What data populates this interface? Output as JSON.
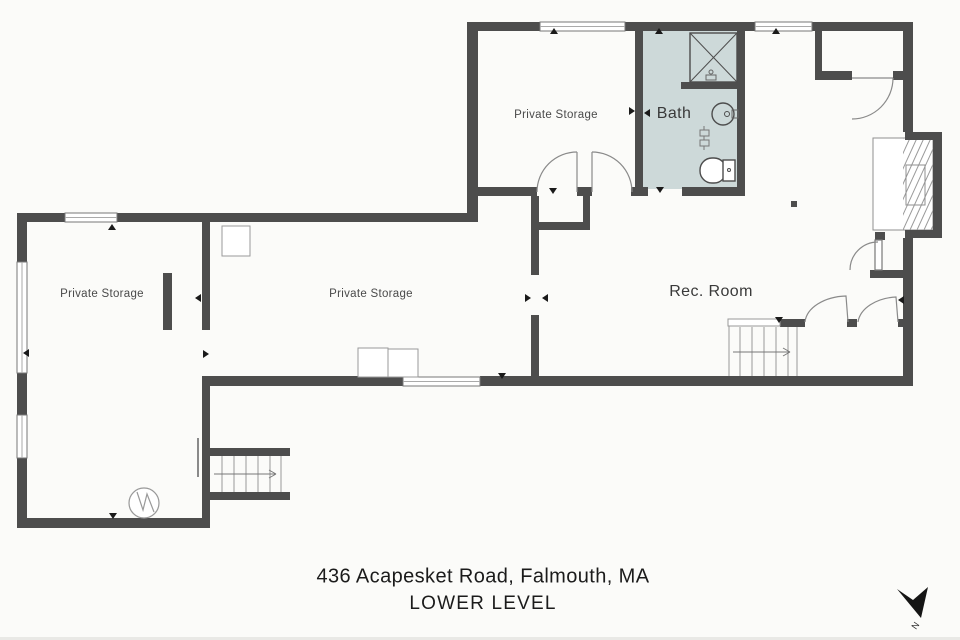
{
  "plan": {
    "rooms": [
      {
        "id": "private-storage-upper",
        "label": "Private Storage"
      },
      {
        "id": "bath",
        "label": "Bath"
      },
      {
        "id": "private-storage-left",
        "label": "Private Storage"
      },
      {
        "id": "private-storage-middle",
        "label": "Private Storage"
      },
      {
        "id": "rec-room",
        "label": "Rec. Room"
      }
    ],
    "title": {
      "address": "436 Acapesket Road, Falmouth, MA",
      "level": "LOWER LEVEL"
    },
    "compass": {
      "label": "N"
    },
    "colors": {
      "wall": "#4d4d4d",
      "bath_floor": "#cdd9d9",
      "background": "#fbfbf9",
      "thin_line": "#8a8a8a",
      "marker": "#1a1a1a",
      "label_text": "#4a4a4a",
      "title_text": "#1b1b1b"
    }
  }
}
